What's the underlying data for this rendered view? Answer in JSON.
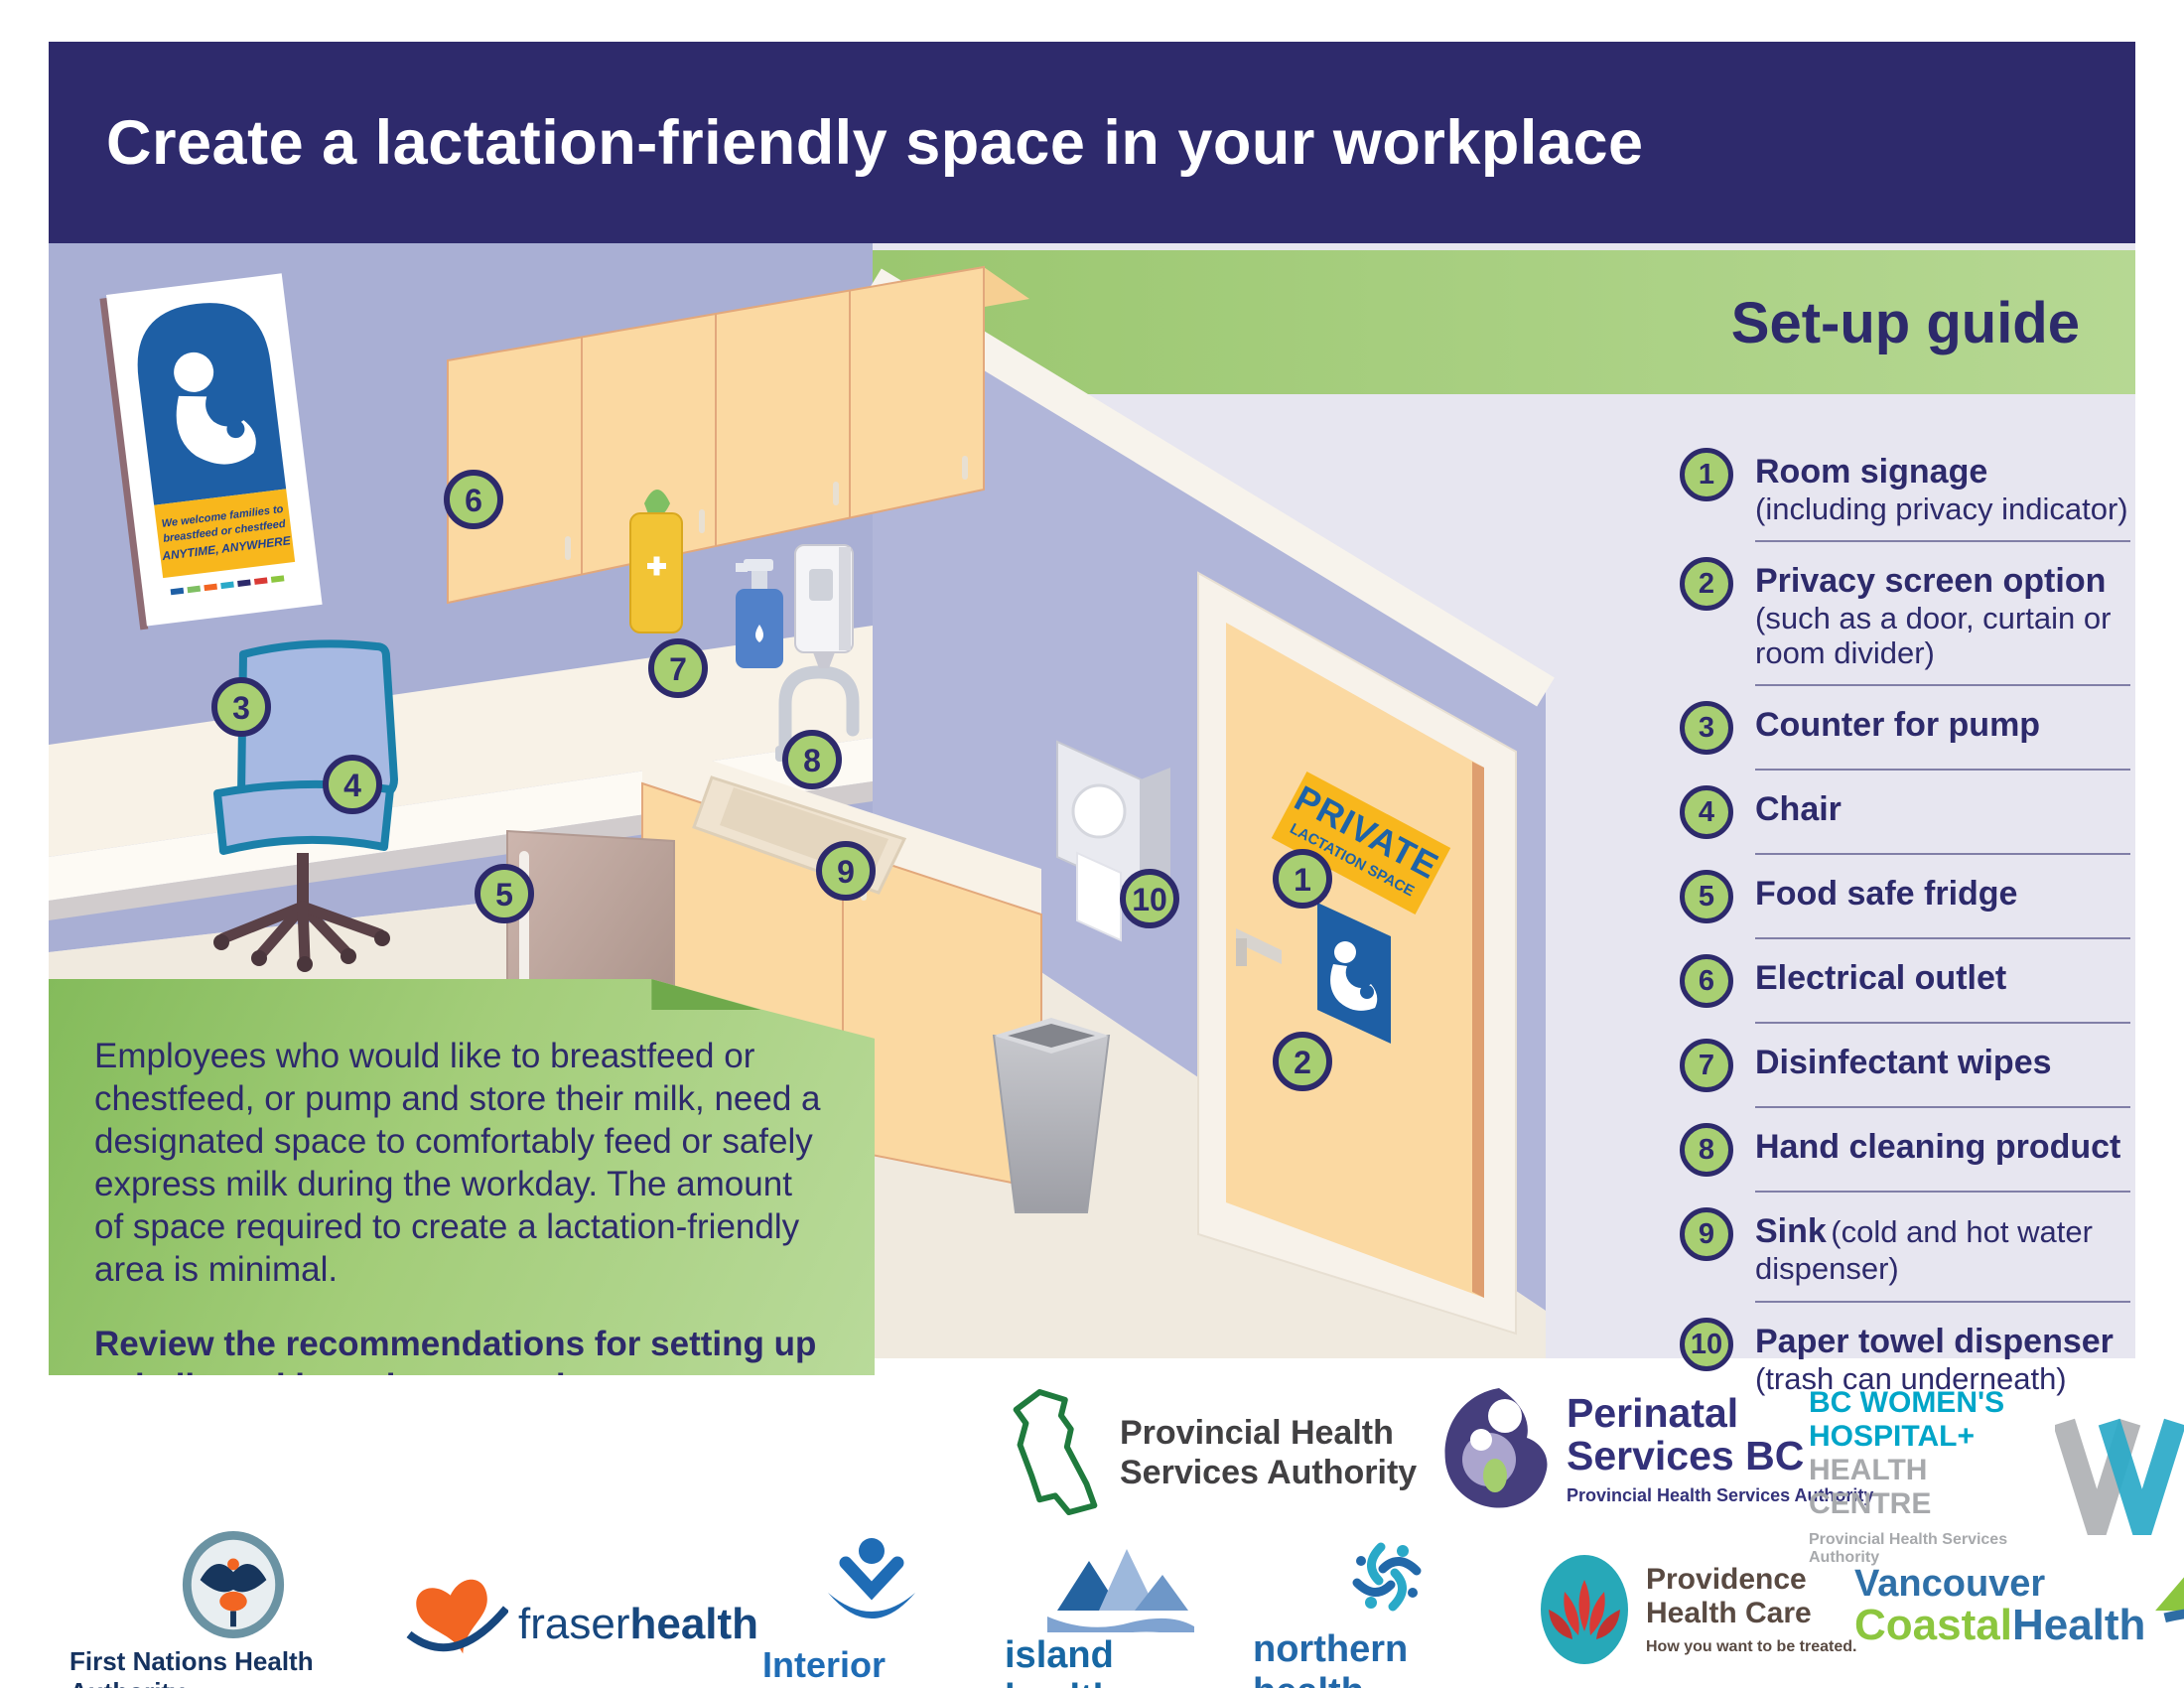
{
  "page": {
    "title": "Create a lactation-friendly space in your workplace",
    "guide_title": "Set-up guide"
  },
  "guide": {
    "items": [
      {
        "num": "1",
        "label": "Room signage",
        "note": "(including privacy indicator)"
      },
      {
        "num": "2",
        "label": "Privacy screen option",
        "note": "(such as a door, curtain or room divider)"
      },
      {
        "num": "3",
        "label": "Counter for pump",
        "note": ""
      },
      {
        "num": "4",
        "label": "Chair",
        "note": ""
      },
      {
        "num": "5",
        "label": "Food safe fridge",
        "note": ""
      },
      {
        "num": "6",
        "label": "Electrical outlet",
        "note": ""
      },
      {
        "num": "7",
        "label": "Disinfectant wipes",
        "note": ""
      },
      {
        "num": "8",
        "label": "Hand cleaning product",
        "note": ""
      },
      {
        "num": "9",
        "label": "Sink",
        "note": "(cold and hot water dispenser)"
      },
      {
        "num": "10",
        "label": "Paper towel dispenser",
        "note": "(trash can underneath)"
      }
    ]
  },
  "bubble": {
    "p1": "Employees who would like to breastfeed or chestfeed, or pump and store their milk, need a designated space to comfortably feed or safely express milk during the workday. The amount of space required to create a lactation-friendly area is minimal.",
    "p2": "Review the recommendations for setting up a dedicated lactation space in your workplace."
  },
  "scene": {
    "badges": [
      "1",
      "2",
      "3",
      "4",
      "5",
      "6",
      "7",
      "8",
      "9",
      "10"
    ],
    "door_sign": {
      "line1": "PRIVATE",
      "line2": "LACTATION SPACE"
    },
    "poster": {
      "line1": "We welcome families to",
      "line2": "breastfeed or chestfeed",
      "line3": "ANYTIME, ANYWHERE"
    }
  },
  "logos": {
    "phsa": {
      "line1": "Provincial Health",
      "line2": "Services Authority"
    },
    "psbc": {
      "line1": "Perinatal",
      "line2": "Services BC",
      "tag": "Provincial Health Services Authority"
    },
    "bcw": {
      "line1": "BC WOMEN'S",
      "line2": "HOSPITAL+",
      "line3": "HEALTH CENTRE",
      "tag": "Provincial Health Services Authority"
    },
    "fnha": {
      "name": "First Nations Health Authority",
      "tag": "Health through wellness"
    },
    "fraser": {
      "name1": "fraser",
      "name2": "health"
    },
    "interior": {
      "name": "Interior Health"
    },
    "island": {
      "name": "island health"
    },
    "northern": {
      "name": "northern health",
      "tag": "the northern way of caring"
    },
    "providence": {
      "line1": "Providence",
      "line2": "Health Care",
      "tag": "How you want to be treated."
    },
    "vch": {
      "line1": "Vancouver",
      "line2a": "Coastal",
      "line2b": "Health"
    }
  },
  "colors": {
    "navy": "#2d2a6b",
    "band_green": "#a8cf72",
    "badge_green": "#a8cf72",
    "sign_yellow": "#f8b71c",
    "sign_blue": "#1e5fa5",
    "wall_lavender": "#a9afd4"
  }
}
